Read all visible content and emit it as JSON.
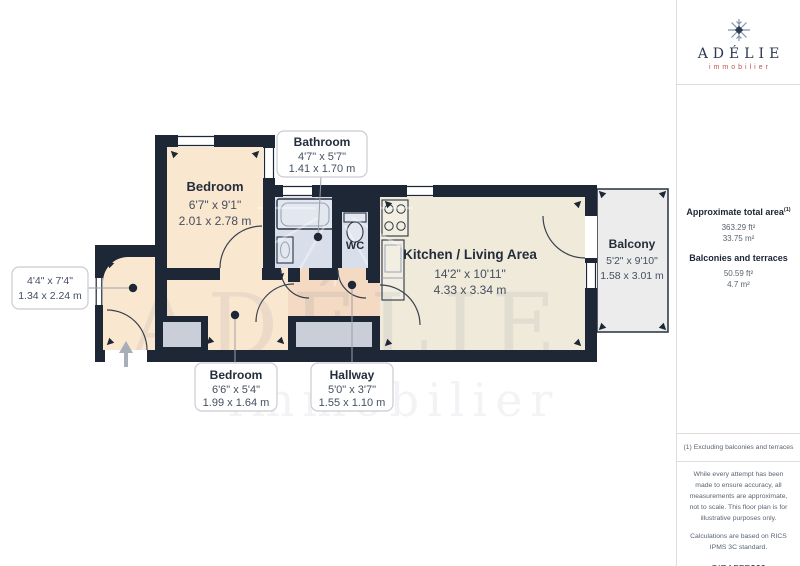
{
  "logo": {
    "brand": "ADÉLIE",
    "tagline": "immobilier",
    "icon": "snowflake-icon"
  },
  "watermark": {
    "brand": "ADÉLIE",
    "tagline": "immobilier"
  },
  "panel": {
    "total_area_label": "Approximate total area",
    "total_area_sup": "(1)",
    "total_area_ft": "363.29 ft²",
    "total_area_m": "33.75 m²",
    "balconies_label": "Balconies and terraces",
    "balconies_ft": "50.59 ft²",
    "balconies_m": "4.7 m²",
    "footnote": "(1) Excluding balconies and terraces",
    "disclaimer_measure": "While every attempt has been made to ensure accuracy, all measurements are approximate, not to scale. This floor plan is for illustrative purposes only.",
    "disclaimer_calc": "Calculations are based on RICS IPMS 3C standard.",
    "credit_brand": "GIRAFFE",
    "credit_suffix": "360"
  },
  "rooms": {
    "bedroom_top": {
      "name": "Bedroom",
      "imperial": "6'7\" x 9'1\"",
      "metric": "2.01 x 2.78 m"
    },
    "bathroom": {
      "name": "Bathroom",
      "imperial": "4'7\" x 5'7\"",
      "metric": "1.41 x 1.70 m"
    },
    "wc": {
      "name": "WC"
    },
    "kitchen_living": {
      "name": "Kitchen / Living Area",
      "imperial": "14'2\" x 10'11\"",
      "metric": "4.33 x 3.34 m"
    },
    "balcony": {
      "name": "Balcony",
      "imperial": "5'2\" x 9'10\"",
      "metric": "1.58 x 3.01 m"
    },
    "bedroom_bottom": {
      "name": "Bedroom",
      "imperial": "6'6\" x 5'4\"",
      "metric": "1.99 x 1.64 m"
    },
    "hallway": {
      "name": "Hallway",
      "imperial": "5'0\" x 3'7\"",
      "metric": "1.55 x 1.10 m"
    },
    "room_unlabeled": {
      "imperial": "4'4\" x 7'4\"",
      "metric": "1.34 x 2.24 m"
    }
  },
  "colors": {
    "wall": "#1D2736",
    "bedroom_floor": "#FAE7D0",
    "hallway_floor": "#F4D9C3",
    "kitchen_floor": "#EFEADA",
    "bathroom_floor": "#D9DEEB",
    "balcony_floor": "#ECECEC",
    "closet": "#C9CED8",
    "brand_navy": "#2D3A52",
    "brand_red": "#C0564F"
  }
}
